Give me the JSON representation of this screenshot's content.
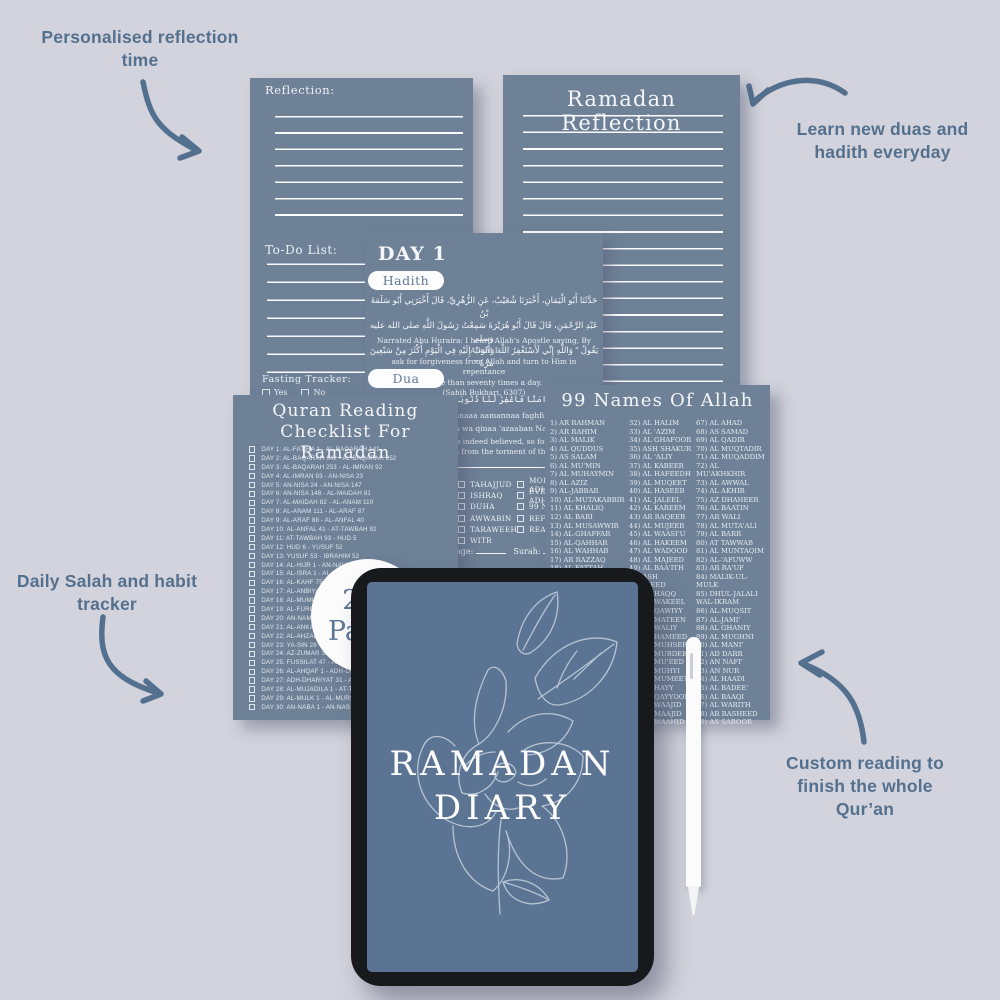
{
  "colors": {
    "background": "#d2d3dc",
    "page": "#6e8197",
    "accent": "#54708f",
    "tablet_screen": "#5c7494",
    "tablet_frame": "#17191d"
  },
  "annotations": {
    "top_left": "Personalised reflection time",
    "top_right": "Learn new duas and hadith everyday",
    "mid_left": "Daily Salah and habit tracker",
    "bottom_right": "Custom reading to finish the whole Qur’an"
  },
  "badge": {
    "line1": "200",
    "line2": "Pages"
  },
  "left_page": {
    "reflection_label": "Reflection:",
    "todo_label": "To-Do List:",
    "fasting_label": "Fasting Tracker:",
    "yes_label": "Yes",
    "no_label": "No"
  },
  "right_page": {
    "title": "Ramadan Reflection"
  },
  "day_page": {
    "title": "DAY 1",
    "hadith_button": "Hadith",
    "hadith_arabic": [
      "حَدَّثَنَا أَبُو الْيَمَانِ، أَخْبَرَنَا شُعَيْبٌ، عَنِ الزُّهْرِيِّ، قَالَ أَخْبَرَنِي أَبُو سَلَمَةَ بْنُ",
      "عَبْدِ الرَّحْمَنِ، قَالَ قَالَ أَبُو هُرَيْرَةَ سَمِعْتُ رَسُولَ اللَّهِ صلى الله عليه وسلم",
      "يَقُولُ \" وَاللَّهِ إِنِّي لَأَسْتَغْفِرُ اللَّهَ وَأَتُوبُ إِلَيْهِ فِي الْيَوْمِ أَكْثَرَ مِنْ سَبْعِينَ مَرَّةً \""
    ],
    "hadith_english": [
      "Narrated Abu Huraira: I heard Allah's Apostle saying, By Allah! I",
      "ask for forgiveness from Allah and turn to Him in repentance",
      "more than seventy times a day.",
      "(Sahih Bukhari, 6307)"
    ],
    "dua_button": "Dua",
    "dua_arabic": "رَبَّنَآ إِنَّنَآ ءَامَنَّا فَاغْفِرْ لَنَا ذُنُوبَنَا وَقِنَا عَذَابَ ٱلنَّارِ",
    "dua_transliteration": [
      "Rabbanaaa innanaaa aamannaa faghfir lanaa",
      "zunoobanaa wa qinaa 'azaaban Naar"
    ],
    "dua_english": [
      "Our Lord! We have indeed believed, so forgive our",
      "sins and save us from the torment of the Fire."
    ],
    "prayer_checklist": [
      "TAHAJJUD",
      "ISHRAQ",
      "DUHA",
      "AWWABIN",
      "TARAWEEH",
      "WITR"
    ],
    "habit_checklist": [
      "MORNING ADHKAR",
      "EVENING ADHKAR",
      "99 NAMES",
      "REFLECTION",
      "READING"
    ],
    "page_label": "Page:",
    "surah_label": "Surah:"
  },
  "quran_page": {
    "title_line1": "Quran Reading",
    "title_line2": "Checklist For Ramadan",
    "items": [
      "DAY 1: AL-FATIHA 1 - AL-BAQARAH 141",
      "DAY 2: AL-BAQARAH 142 - AL-BAQARAH 252",
      "DAY 3: AL-BAQARAH 253 - AL-IMRAN 92",
      "DAY 4: AL-IMRAN 93 - AN-NISA 23",
      "DAY 5: AN-NISA 24 - AN-NISA 147",
      "DAY 6: AN-NISA 148 - AL-MAIDAH 81",
      "DAY 7: AL-MAIDAH 82 - AL-ANAM 110",
      "DAY 8: AL-ANAM 111 - AL-ARAF 87",
      "DAY 9: AL-ARAF 88 - AL-ANFAL 40",
      "DAY 10: AL-ANFAL 41 - AT-TAWBAH 92",
      "DAY 11: AT-TAWBAH 93 - HUD 5",
      "DAY 12: HUD 6 - YUSUF 52",
      "DAY 13: YUSUF 53 - IBRAHIM 52",
      "DAY 14: AL-HIJR 1 - AN-NAHL 128",
      "DAY 15: AL-ISRA 1 - AL-KAHF 74",
      "DAY 16: AL-KAHF 75 - TA-HA 135",
      "DAY 17: AL-ANBIYA 1 - AL-HAJJ 78",
      "DAY 18: AL-MUMINUN 1 - AL-FURQAN 20",
      "DAY 19: AL-FURQAN 21 - AN-NAML 55",
      "DAY 20: AN-NAML 56 - AL-ANKABUT 45",
      "DAY 21: AL-ANKABUT 46 - AL-AHZAB 30",
      "DAY 22: AL-AHZAB 31 - YA-SIN 27",
      "DAY 23: YA-SIN 28 - AZ-ZUMAR 31",
      "DAY 24: AZ-ZUMAR 32 - FUSSILAT 46",
      "DAY 25: FUSSILAT 47 - AL-JATHIYA 37",
      "DAY 26: AL-AHQAF 1 - ADH-DHARIYAT 30",
      "DAY 27: ADH-DHARIYAT 31 - AL-HADID 29",
      "DAY 28: AL-MUJADILA 1 - AT-TAHRIM 12",
      "DAY 29: AL-MULK 1 - AL-MURSALAT 50",
      "DAY 30: AN-NABA 1 - AN-NAS 6"
    ]
  },
  "names_page": {
    "title": "99 Names Of Allah",
    "col1": [
      "1) AR RAHMAN",
      "2) AR RAHIM",
      "3) AL MALIK",
      "4) AL QUDDUS",
      "5) AS SALAM",
      "6) AL MU'MIN",
      "7) AL MUHAYMIN",
      "8) AL AZIZ",
      "9) AL-JABBAR",
      "10) AL-MUTAKABBIR",
      "11) AL KHALIQ",
      "12) AL BARI",
      "13) AL MUSAWWIR",
      "14) AL-GHAFFAR",
      "15) AL-QAHHAR",
      "16) AL WAHHAB",
      "17) AR RAZZAQ",
      "18) AL FATTAH",
      "19) AL ALEEM",
      "20) AL QAABID",
      "21) AL BAASIT",
      "22) AL KHAFIDH",
      "23) AR RAFI",
      "24) AL MU'IZZ",
      "25) AL MUDHILL",
      "26) AS SAMEE",
      "27) AL BASEER",
      "28) AL HAKAM",
      "29) AL ADL",
      "30) AL LATEEF",
      "31) AL KHABEER"
    ],
    "col2": [
      "32) AL HALIM",
      "33) AL 'AZIM",
      "34) AL GHAFOOR",
      "35) ASH SHAKUR",
      "36) AL 'ALIY",
      "37) AL KABEER",
      "38) AL HAFEEDH",
      "39) AL MUQEET",
      "40) AL HASEEB",
      "41) AL JALEEL",
      "42) AL KAREEM",
      "43) AR RAQEEB",
      "44) AL MUJEEB",
      "45) AL WAASI'U",
      "46) AL HAKEEM",
      "47) AL WADOOD",
      "48) AL MAJEED",
      "49) AL BAA'ITH",
      "50) ASH SHAHEED",
      "51) AL HAQQ",
      "52) AL WAKEEL",
      "53) AL QAWIYY",
      "54) AL MATEEN",
      "55) AL WALIY",
      "56) AL HAMEED",
      "57) AL MUHSEE",
      "58) AL MUBDEE",
      "59) AL MU'EED",
      "60) AL MUHYI",
      "61) AL MUMEET",
      "62) AL HAYY",
      "63) AL QAYYOOM",
      "64) AL WAAJID",
      "65) AL MAAJID",
      "66) AL WAAHID"
    ],
    "col3": [
      "67) AL AHAD",
      "68) AS SAMAD",
      "69) AL QADIR",
      "70) AL MUQTADIR",
      "71) AL MUQADDIM",
      "72) AL MU'AKHKHIR",
      "73) AL AWWAL",
      "74) AL AKHIR",
      "75) AZ DHAHEER",
      "76) AL BAATIN",
      "77) AR WALI",
      "78) AL MUTA'ALI",
      "79) AL BARR",
      "80) AT TAWWAB",
      "81) AL MUNTAQIM",
      "82) AL-'AFUWW",
      "83) AR RA'UF",
      "84) MALIK-UL-MULK",
      "85) DHUL-JALALI WAL-IKRAM",
      "86) AL-MUQSIT",
      "87) AL-JAMI'",
      "88) AL GHANIY",
      "89) AL MUGHNI",
      "90) AL MANI'",
      "91) AD DARR",
      "92) AN NAFI'",
      "93) AN NUR",
      "94) AL HAADI",
      "95) AL BADEE'",
      "96) AL BAAQI",
      "97) AL WARITH",
      "98) AR RASHEED",
      "99) AS SABOOR"
    ]
  },
  "tablet": {
    "title_line1": "RAMADAN",
    "title_line2": "DIARY"
  }
}
